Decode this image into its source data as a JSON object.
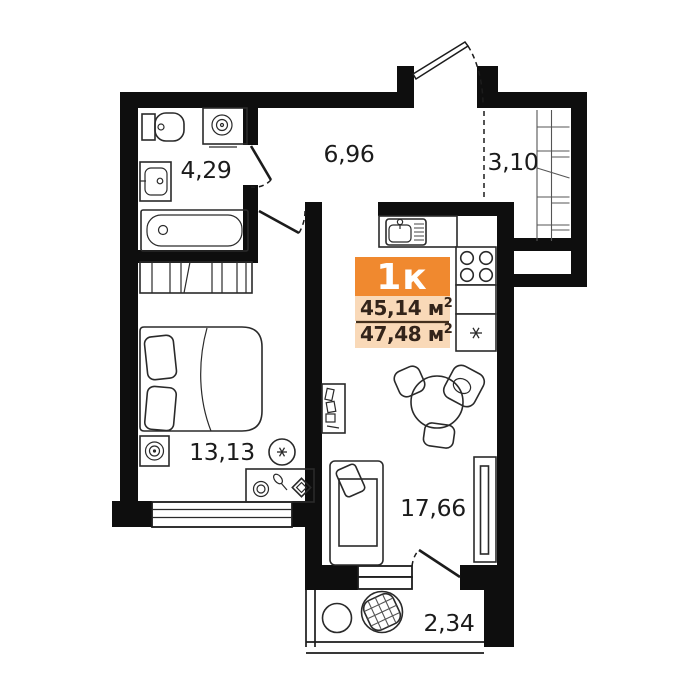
{
  "title": "Apartment floor plan",
  "badge": {
    "type_label": "1к",
    "rows": [
      {
        "value": "45,14",
        "unit": " м",
        "sup": "2"
      },
      {
        "value": "47,48",
        "unit": " м",
        "sup": "2"
      }
    ]
  },
  "rooms": {
    "bathroom": {
      "area": "4,29"
    },
    "hallway": {
      "area": "6,96"
    },
    "storage": {
      "area": "3,10"
    },
    "bedroom": {
      "area": "13,13"
    },
    "kitchen_living": {
      "area": "17,66"
    },
    "balcony": {
      "area": "2,34"
    }
  },
  "icons": {
    "fridge": "snowflake-icon",
    "bedroom_ceiling": "light-asterisk-icon"
  },
  "colors": {
    "wall": "#0e0e0e",
    "fixture_line": "#2a2a2a",
    "badge_orange": "#f0892f",
    "badge_light": "#f9d9b8",
    "badge_divider": "#44301d",
    "badge_text": "#33241a",
    "label_text": "#1b1b1b",
    "background": "#ffffff"
  }
}
